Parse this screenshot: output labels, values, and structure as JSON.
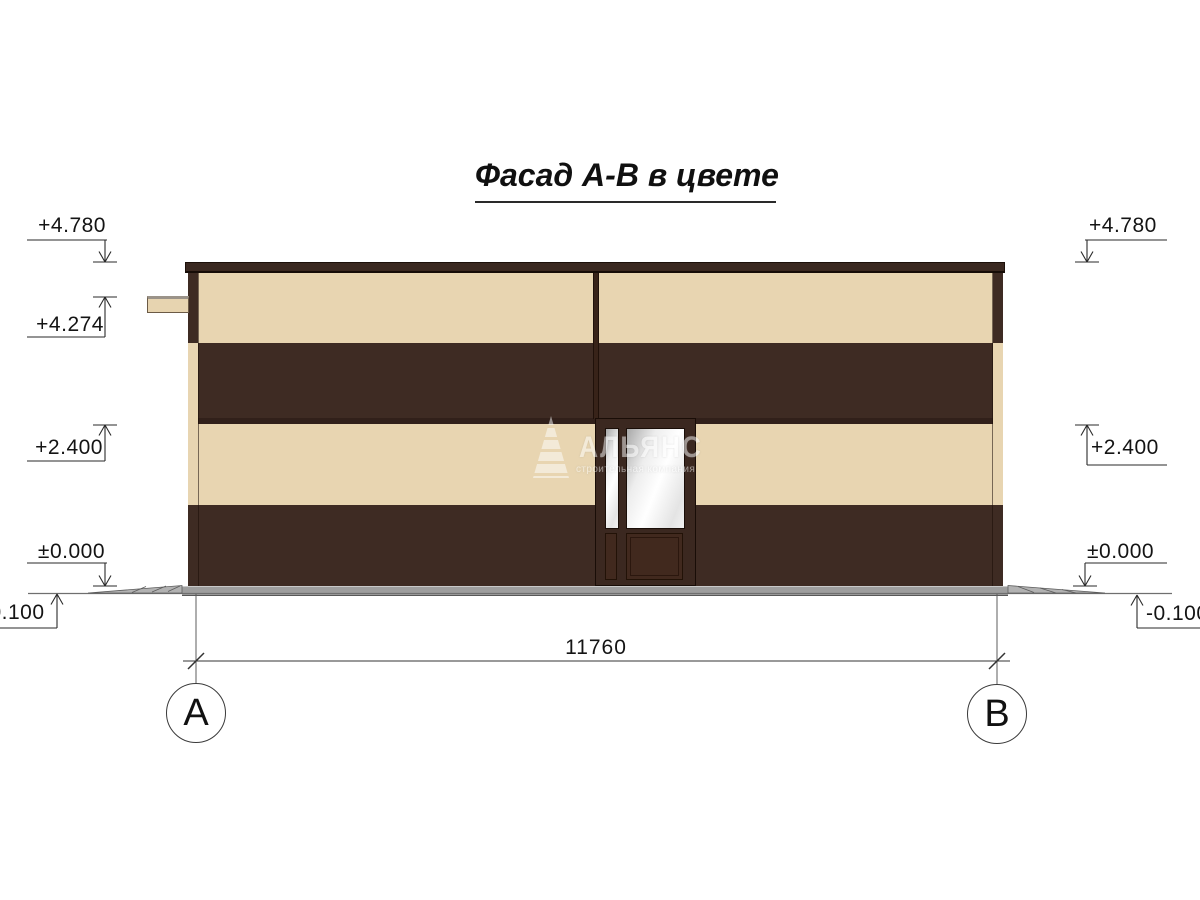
{
  "title": "Фасад А-В в цвете",
  "levels": {
    "parapet": "+4.780",
    "canopy": "+4.274",
    "storey": "+2.400",
    "zero": "±0.000",
    "ground": "-0.100"
  },
  "dimension": {
    "overall_width": "11760"
  },
  "axes": {
    "left": "А",
    "right": "В"
  },
  "watermark": {
    "brand": "АЛЬЯНС",
    "tagline": "строительная компания"
  },
  "colors": {
    "facade_dark": "#3E2B23",
    "facade_cream": "#E8D5B1",
    "plinth_gray": "#9E9E9E",
    "line": "#2A2A2A"
  }
}
